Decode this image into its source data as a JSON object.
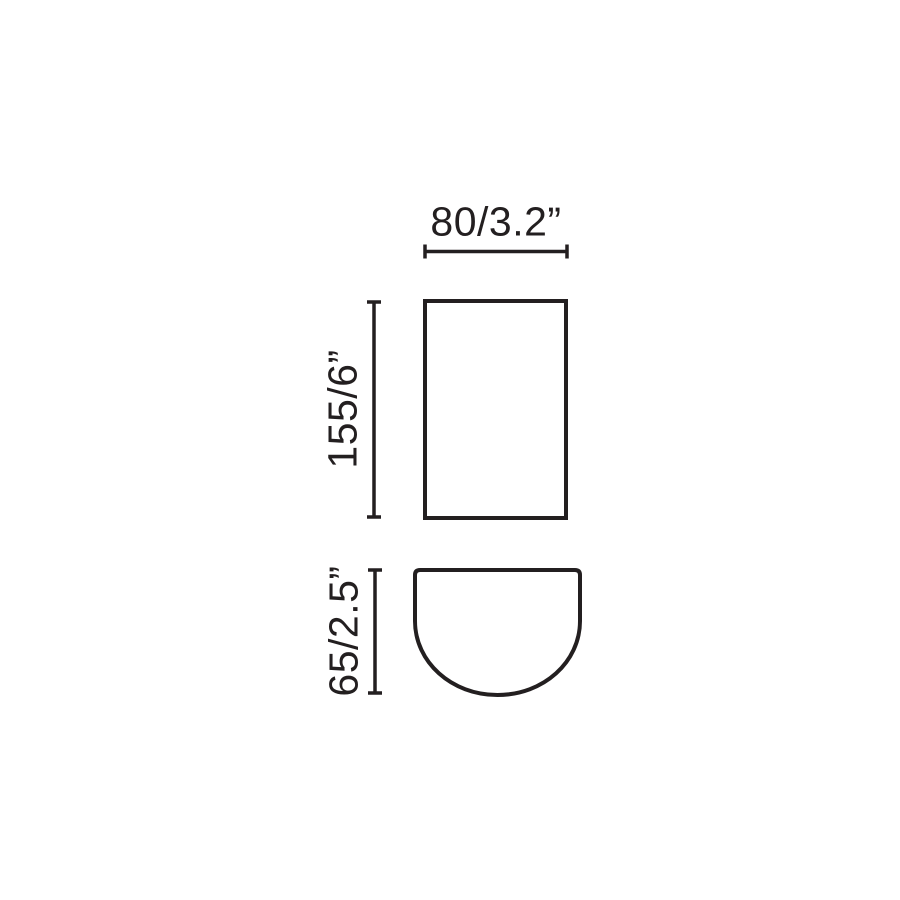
{
  "page": {
    "background_color": "#ffffff"
  },
  "diagram": {
    "stroke_color": "#231f20",
    "text_color": "#231f20",
    "views": {
      "front": "rectangle-front-view",
      "top": "half-round-top-view"
    },
    "labels": {
      "width": "80/3.2”",
      "height": "155/6”",
      "depth": "65/2.5”"
    }
  }
}
